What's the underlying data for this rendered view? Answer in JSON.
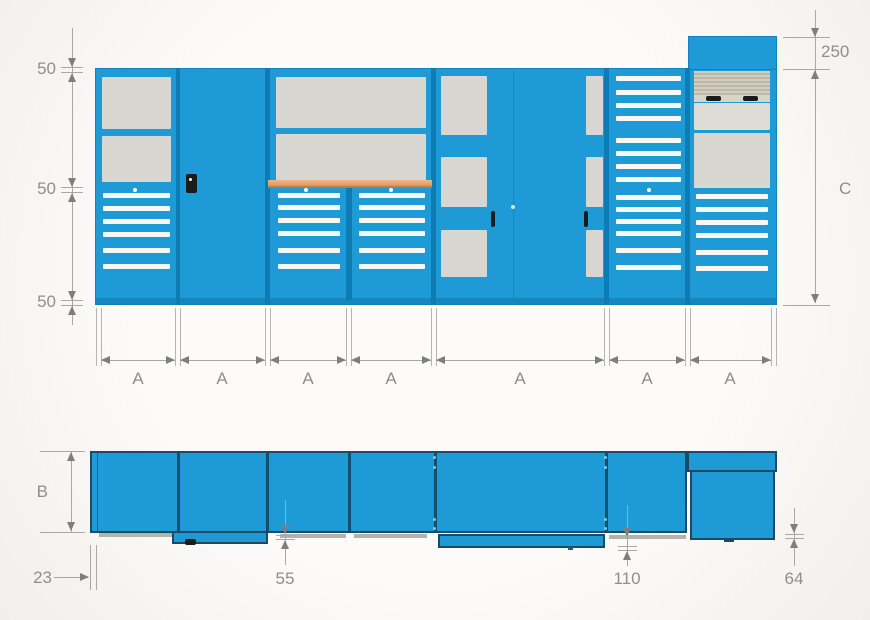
{
  "front": {
    "left_height_dims": [
      "50",
      "50",
      "50"
    ],
    "top_unit_height_dim": "250",
    "total_height_dim": "C",
    "module_width_dims": [
      "A",
      "A",
      "A",
      "A",
      "A",
      "A",
      "A"
    ]
  },
  "plan": {
    "depth_dim": "B",
    "left_offset_dim": "23",
    "worktop_overhang_dim": "55",
    "center_overhang_dim": "110",
    "right_overhang_dim": "64"
  },
  "colors": {
    "cabinet_blue": "#1e9ad7",
    "panel_gray": "#d8d6d1",
    "worktop_tan": "#eeab7d",
    "shutter_beige": "#ccc7b8",
    "dimension_gray": "#8f8f8f"
  }
}
